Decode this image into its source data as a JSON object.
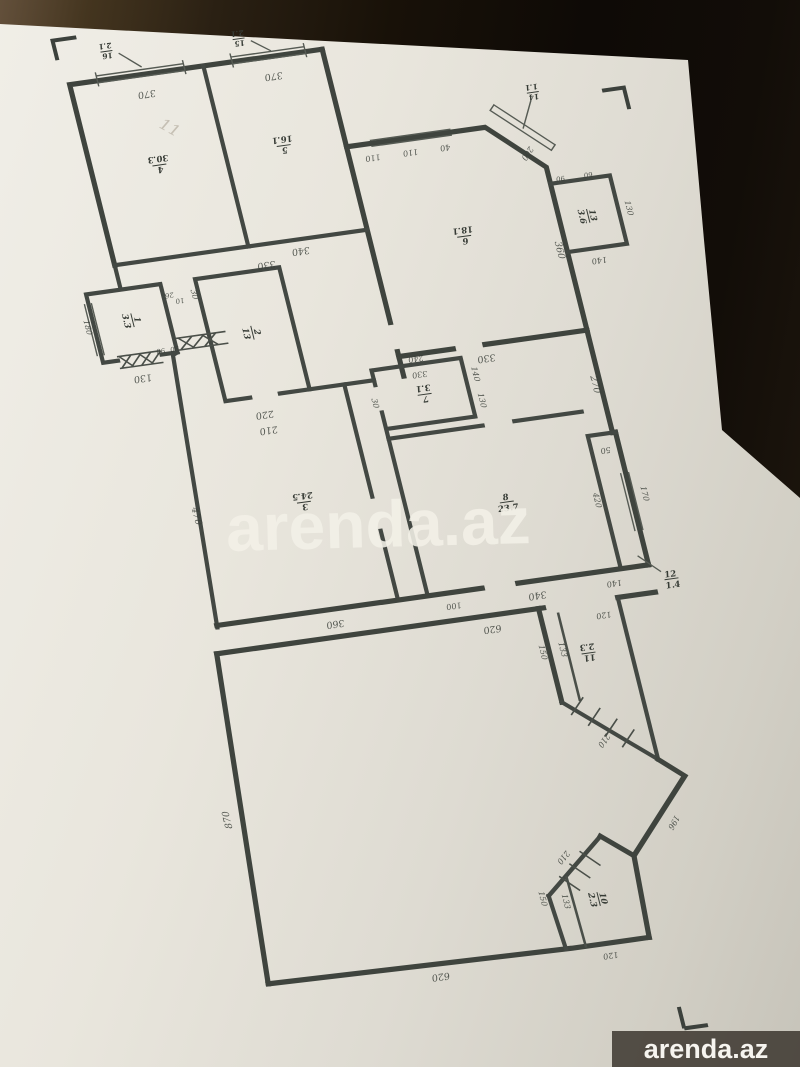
{
  "watermark": {
    "center": "arenda.az",
    "badge": "arenda.az"
  },
  "pencil_note": "11",
  "colors": {
    "paper": "#e9e6dd",
    "ink": "#3f443e",
    "background_dark": "#14100a",
    "badge_bg": "rgba(54,47,40,0.82)",
    "watermark_text": "rgba(243,240,231,0.88)"
  },
  "rooms": {
    "r1": {
      "num": "1",
      "area": "3.3"
    },
    "r2": {
      "num": "2",
      "area": "13"
    },
    "r3": {
      "num": "3",
      "area": "24.5"
    },
    "r4": {
      "num": "4",
      "area": "30.3"
    },
    "r5": {
      "num": "5",
      "area": "16.1"
    },
    "r6": {
      "num": "6",
      "area": "18.1"
    },
    "r7": {
      "num": "7",
      "area": "3.1"
    },
    "r8": {
      "num": "8",
      "area": "23.7"
    },
    "r10": {
      "num": "10",
      "area": "2.3"
    },
    "r11": {
      "num": "11",
      "area": "2.3"
    },
    "r12": {
      "num": "12",
      "area": "1.4"
    },
    "r13": {
      "num": "13",
      "area": "3.6"
    },
    "b14": {
      "num": "14",
      "area": "1.1"
    },
    "b15": {
      "num": "15",
      "area": "2.1"
    },
    "b16": {
      "num": "16",
      "area": "2.1"
    }
  },
  "dims": {
    "w370a": "370",
    "w370b": "370",
    "b340": "340",
    "r2top330": "330",
    "r6a110": "110",
    "r6b110": "110",
    "r6c40": "40",
    "r6d200": "200",
    "r6r360": "360",
    "r6s330": "330",
    "r13a90": "90",
    "r13b60": "60",
    "r13r130": "130",
    "r13s140": "140",
    "e270": "270",
    "r7a240": "240",
    "r7b330": "330",
    "r7l30": "30",
    "r7r140": "140",
    "r7r130": "130",
    "r1s130": "130",
    "r1a90": "90",
    "r1b90": "90",
    "r1l180": "180",
    "r1w26": "26",
    "r1w10": "10",
    "r2l30": "30",
    "r2a220": "220",
    "r2b210": "210",
    "h470": "470",
    "h360": "360",
    "r8a100": "100",
    "r8b340": "340",
    "r8c140": "140",
    "c620": "620",
    "r12a50": "50",
    "r12l420": "420",
    "r12r170": "170",
    "r11a120": "120",
    "r11l133": "133",
    "r11o150": "150",
    "r11d210": "210",
    "s196": "196",
    "w870": "870",
    "b620": "620",
    "r10d210": "210",
    "r10l133": "133",
    "r10o150": "150",
    "r10s120": "120"
  }
}
